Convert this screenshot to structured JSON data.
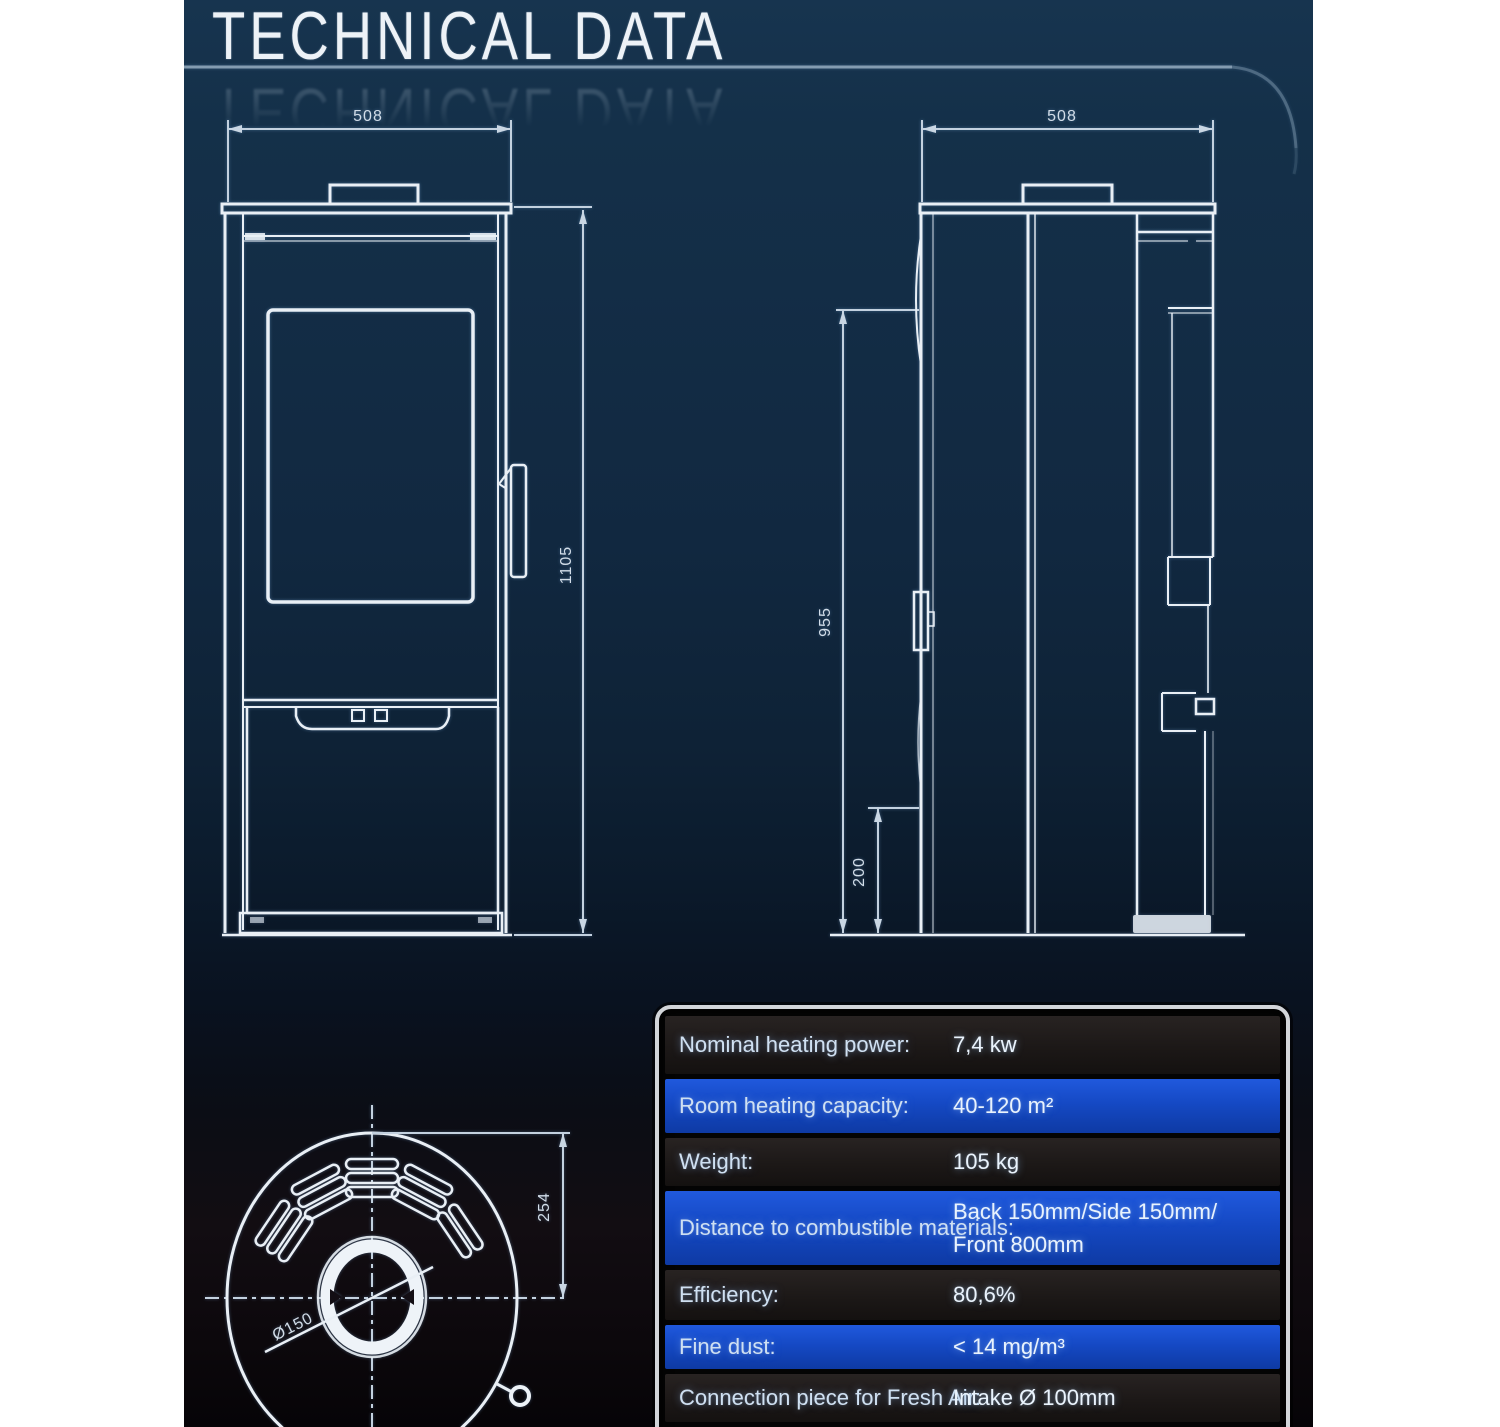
{
  "page": {
    "title": "TECHNICAL DATA"
  },
  "drawings": {
    "front_view": {
      "name": "stove front view",
      "width_label": "508",
      "height_label": "1105"
    },
    "side_view": {
      "name": "stove side view",
      "depth_label": "508",
      "height_label": "955",
      "clearance_label": "200"
    },
    "top_view": {
      "name": "stove top view",
      "radius_label": "254",
      "flue_diameter_label": "Ø150"
    }
  },
  "table": {
    "rows": [
      {
        "label": "Nominal heating power:",
        "value": "7,4 kw"
      },
      {
        "label": "Room heating capacity:",
        "value": "40-120 m²"
      },
      {
        "label": "Weight:",
        "value": "105 kg"
      },
      {
        "label": "Distance to combustible materials:",
        "value": "Back 150mm/Side 150mm/",
        "value2": "Front 800mm"
      },
      {
        "label": "Efficiency:",
        "value": "80,6%"
      },
      {
        "label": "Fine dust:",
        "value": "< 14 mg/m³"
      },
      {
        "label": "Connection piece for Fresh Air:",
        "value": "Intake Ø 100mm"
      }
    ]
  },
  "colors": {
    "page_margin": "#ffffff",
    "background_top": "#17344f",
    "background_bottom": "#060407",
    "drawing_line": "#e9eff5",
    "dimension_line": "#c3d1df",
    "table_border": "#d2d5d9",
    "table_row_dark": "#1c1817",
    "table_row_blue": "#1549c4",
    "table_text": "#e9f3fd",
    "title_text": "#edf2f7"
  }
}
